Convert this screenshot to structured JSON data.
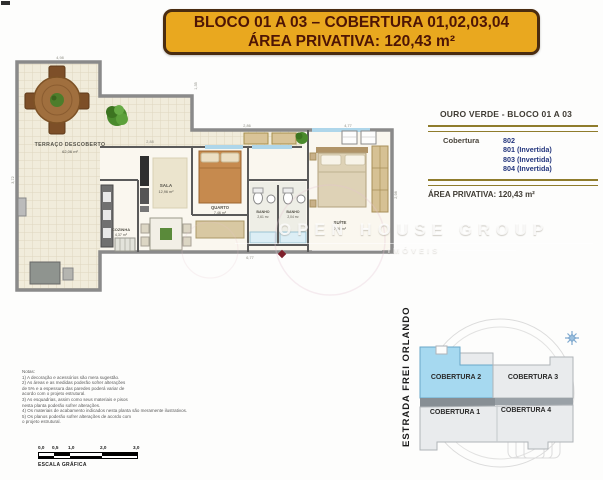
{
  "banner": {
    "line1": "BLOCO 01 A 03 – COBERTURA 01,02,03,04",
    "line2": "ÁREA PRIVATIVA: 120,43 m²",
    "bg_color": "#e9a81f",
    "text_color": "#4e1505"
  },
  "info_panel": {
    "title": "OURO VERDE - BLOCO 01 A 03",
    "type_label": "Cobertura",
    "units": [
      "802",
      "801 (Invertida)",
      "803 (Invertida)",
      "804 (Invertida)"
    ],
    "area_line": "ÁREA PRIVATIVA: 120,43 m²",
    "rule_color": "#8f7c2c",
    "unit_color": "#24367d"
  },
  "plan": {
    "rooms": {
      "terraco": {
        "name": "TERRAÇO DESCOBERTO",
        "area": "62,06 m²"
      },
      "sala": {
        "name": "SALA",
        "area": "12,96 m²"
      },
      "cozinha": {
        "name": "COZINHA",
        "area": "4,37 m²"
      },
      "quarto": {
        "name": "QUARTO",
        "area": "7,46 m²"
      },
      "banho1": {
        "name": "BANHO",
        "area": "2,61 m²"
      },
      "banho2": {
        "name": "BANHO",
        "area": "2,04 m²"
      },
      "suite": {
        "name": "SUÍTE",
        "area": "7,90 m²"
      }
    },
    "dims": [
      "4,98",
      "2,88",
      "1,35",
      "2,86",
      "4,77",
      "2,98",
      "3,72",
      "6,77"
    ]
  },
  "site_plan": {
    "street": "ESTRADA FREI ORLANDO",
    "blocks": [
      {
        "label": "COBERTURA 2",
        "highlighted": true
      },
      {
        "label": "COBERTURA 3",
        "highlighted": false
      },
      {
        "label": "COBERTURA 1",
        "highlighted": false
      },
      {
        "label": "COBERTURA 4",
        "highlighted": false
      }
    ],
    "highlight_color": "#a6d9f0"
  },
  "watermark": {
    "line1": "OPEN HOUSE GROUP",
    "line2": "IMÓVEIS"
  },
  "notes": {
    "lines": [
      "Notas:",
      "1) A decoração e acessórios são mera sugestão.",
      "2) As áreas e as medidas poderão sofrer alterações",
      "de 5% e a espessura das paredes poderá variar de",
      "acordo com o projeto estrutural.",
      "3) As esquadrias, assim como seus materiais e pisos",
      "nesta planta poderão sofrer alterações.",
      "4) Os materiais de acabamento indicados nesta planta são meramente ilustrativos.",
      "5) Os planos poderão sofrer alterações de acordo com",
      "o projeto estrutural."
    ]
  },
  "scale": {
    "ticks": [
      "0,0",
      "0,5",
      "1,0",
      "2,0",
      "3,0"
    ],
    "caption": "ESCALA GRÁFICA"
  }
}
